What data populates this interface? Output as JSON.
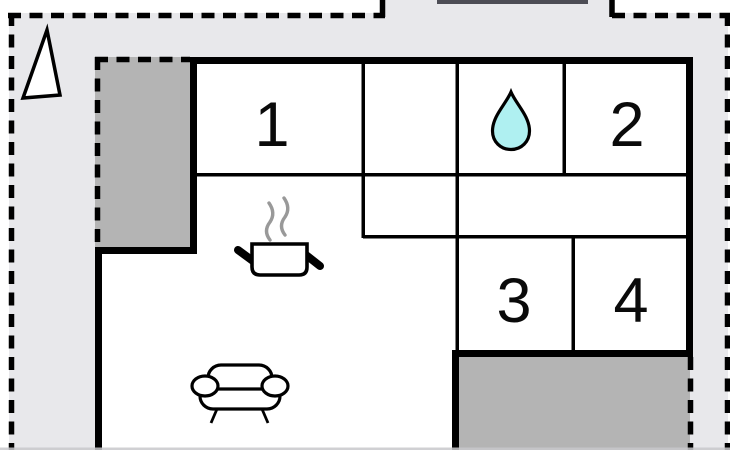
{
  "plan": {
    "type": "floor-plan",
    "rooms": [
      {
        "label": "1"
      },
      {
        "label": "2"
      },
      {
        "label": "3"
      },
      {
        "label": "4"
      }
    ],
    "icons": {
      "north_arrow": "north-arrow",
      "water_drop": "water-drop-icon",
      "cooking_pot": "cooking-pot-icon",
      "steam": "steam-icon",
      "sofa": "sofa-icon"
    },
    "colors": {
      "wall": "#000000",
      "interior": "#ffffff",
      "plot_fill": "#e8e8eb",
      "terrace_fill": "#b4b4b4",
      "water_drop_fill": "#aff0f1",
      "steam": "#999999",
      "top_bar": "#4d4d55",
      "bottom_edge": "#c8c8cb"
    }
  }
}
